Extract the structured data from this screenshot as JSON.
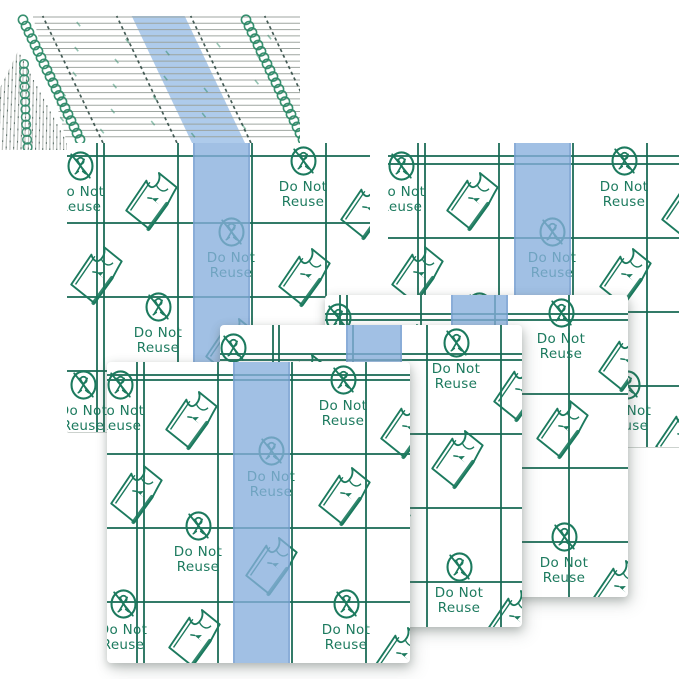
{
  "print": {
    "do_not_reuse_label": {
      "line1": "Do Not",
      "line2": "Reuse"
    },
    "icons": [
      "no-scissors-icon",
      "peel-corner-icon"
    ]
  },
  "colors": {
    "background": "#ffffff",
    "print_green": "#1c7a5e",
    "grid_line": "rgba(23,105,83,0.88)",
    "stripe_blue_solid": "#a7c7e9",
    "stripe_blue_overlay": "rgba(134,174,221,0.78)",
    "band_edge_gray": "#9aa29c",
    "tick_dark": "#26413a",
    "side_stripe_gray": "#bcc1bd",
    "chain_green": "#2d8a68"
  }
}
